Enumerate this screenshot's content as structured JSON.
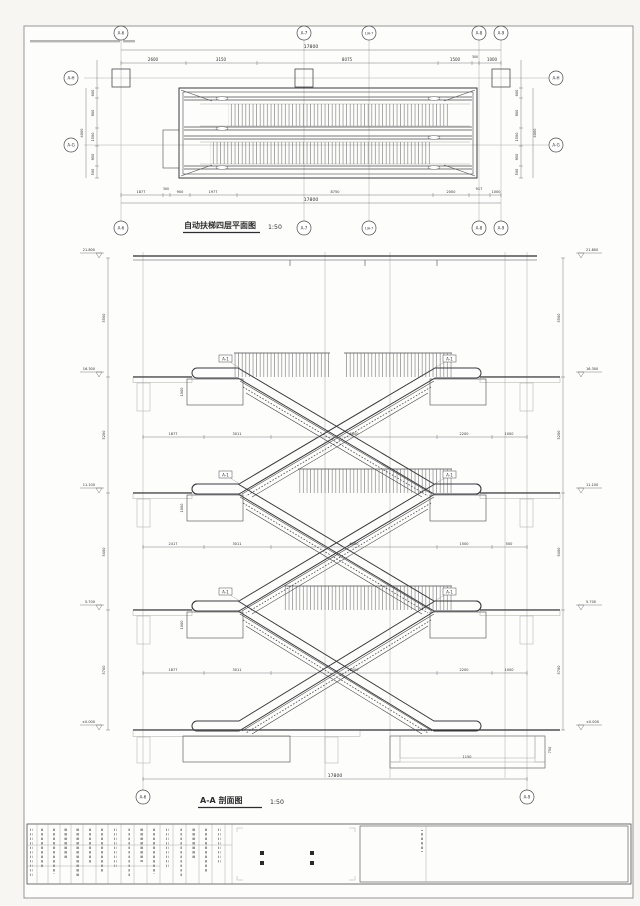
{
  "plan": {
    "title": "自动扶梯四层平面图",
    "scale": "1:50",
    "grid_cols": [
      "A-6",
      "A-7",
      "1/A-7",
      "A-8",
      "A-9"
    ],
    "grid_rows": [
      "A-H",
      "A-G"
    ],
    "dim_total": "17800",
    "dims_top": [
      "2600",
      "3150",
      "8075",
      "1500",
      "300",
      "1000"
    ],
    "dims_bottom": [
      "1877",
      "300",
      "900",
      "1977",
      "8750",
      "2000",
      "917",
      "1000"
    ],
    "dims_left": [
      "600",
      "900",
      "1500",
      "950",
      "500"
    ],
    "dims_right": [
      "600",
      "900",
      "1500",
      "950",
      "500"
    ],
    "dim_side_total": "4000"
  },
  "section": {
    "title": "A-A 剖面图",
    "scale": "1:50",
    "grid_ends": [
      "A-6",
      "A-9"
    ],
    "levels": [
      "21.800",
      "16.300",
      "11.100",
      "5.700",
      "±0.000"
    ],
    "floor_heights": [
      "5500",
      "5200",
      "5400",
      "5700"
    ],
    "dim_rows": [
      [
        "1877",
        "3011",
        "6000",
        "2200",
        "1000"
      ],
      [
        "2417",
        "3011",
        "6000",
        "1500",
        "500"
      ],
      [
        "1877",
        "3011",
        "6000",
        "2200",
        "1000"
      ]
    ],
    "dim_total": "17800",
    "support_dim": "1000",
    "pit_dims": [
      "1150",
      "750"
    ],
    "tag": "A-1"
  }
}
